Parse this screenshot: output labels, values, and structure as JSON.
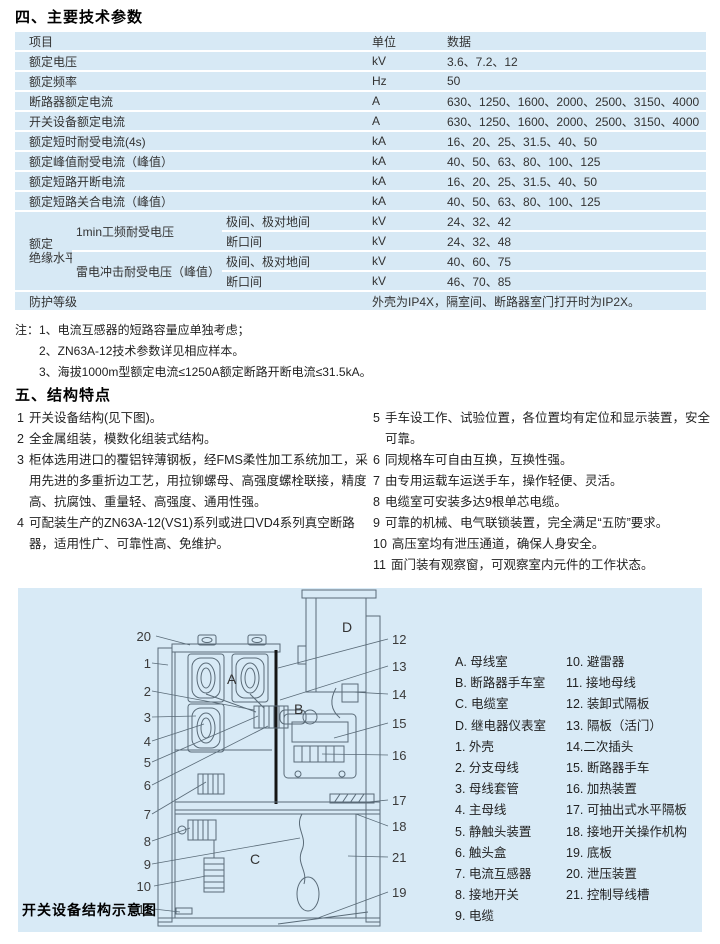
{
  "colors": {
    "table_bg": "#d7e9f5",
    "panel_bg": "#d8eaf6"
  },
  "s4": {
    "title": "四、主要技术参数",
    "table": {
      "col_item": "项目",
      "col_unit": "单位",
      "col_data": "数据",
      "rows": [
        {
          "item": "额定电压",
          "unit": "kV",
          "data": "3.6、7.2、12"
        },
        {
          "item": "额定频率",
          "unit": "Hz",
          "data": "50"
        },
        {
          "item": "断路器额定电流",
          "unit": "A",
          "data": "630、1250、1600、2000、2500、3150、4000"
        },
        {
          "item": "开关设备额定电流",
          "unit": "A",
          "data": "630、1250、1600、2000、2500、3150、4000"
        },
        {
          "item": "额定短时耐受电流(4s)",
          "unit": "kA",
          "data": "16、20、25、31.5、40、50"
        },
        {
          "item": "额定峰值耐受电流（峰值）",
          "unit": "kA",
          "data": "40、50、63、80、100、125"
        },
        {
          "item": "额定短路开断电流",
          "unit": "kA",
          "data": "16、20、25、31.5、40、50"
        },
        {
          "item": "额定短路关合电流（峰值）",
          "unit": "kA",
          "data": "40、50、63、80、100、125"
        }
      ],
      "insulation": {
        "group_line1": "额定",
        "group_line2": "绝缘水平",
        "power_freq_label": "1min工频耐受电压",
        "impulse_label": "雷电冲击耐受电压（峰值）",
        "between_poles": "极间、极对地间",
        "across_gap": "断口间",
        "unit": "kV",
        "pf_poles_data": "24、32、42",
        "pf_gap_data": "24、32、48",
        "imp_poles_data": "40、60、75",
        "imp_gap_data": "46、70、85"
      },
      "protection": {
        "item": "防护等级",
        "data": "外壳为IP4X，隔室间、断路器室门打开时为IP2X。"
      }
    },
    "notes_prefix": "注：",
    "notes": [
      "1、电流互感器的短路容量应单独考虑；",
      "2、ZN63A-12技术参数详见相应样本。",
      "3、海拔1000m型额定电流≤1250A额定断路开断电流≤31.5kA。"
    ]
  },
  "s5": {
    "title": "五、结构特点",
    "left": [
      {
        "num": "1",
        "text": "开关设备结构(见下图)。"
      },
      {
        "num": "2",
        "text": "全金属组装，模数化组装式结构。"
      },
      {
        "num": "3",
        "text": "柜体选用进口的覆铝锌薄钢板，经FMS柔性加工系统加工，采用先进的多重折边工艺，用拉铆螺母、高强度螺栓联接，精度高、抗腐蚀、重量轻、高强度、通用性强。"
      },
      {
        "num": "4",
        "text": "可配装生产的ZN63A-12(VS1)系列或进口VD4系列真空断路器，适用性广、可靠性高、免维护。"
      }
    ],
    "right": [
      {
        "num": "5",
        "text": "手车设工作、试验位置，各位置均有定位和显示装置，安全可靠。"
      },
      {
        "num": "6",
        "text": "同规格车可自由互换，互换性强。"
      },
      {
        "num": "7",
        "text": "由专用运载车运送手车，操作轻便、灵活。"
      },
      {
        "num": "8",
        "text": "电缆室可安装多达9根单芯电缆。"
      },
      {
        "num": "9",
        "text": "可靠的机械、电气联锁装置，完全满足“五防”要求。"
      },
      {
        "num": "10",
        "text": "高压室均有泄压通道，确保人身安全。"
      },
      {
        "num": "11",
        "text": "面门装有观察窗，可观察室内元件的工作状态。"
      }
    ]
  },
  "diagram": {
    "caption": "开关设备结构示意图",
    "compartments": {
      "a": "A",
      "b": "B",
      "c": "C",
      "d": "D"
    },
    "left_labels": [
      "20",
      "1",
      "2",
      "3",
      "4",
      "5",
      "6",
      "7",
      "8",
      "9",
      "10",
      "11"
    ],
    "right_labels": [
      "12",
      "13",
      "14",
      "15",
      "16",
      "17",
      "18",
      "21",
      "19"
    ],
    "legend_col1": [
      "A. 母线室",
      "B. 断路器手车室",
      "C. 电缆室",
      "D. 继电器仪表室",
      "1. 外壳",
      "2. 分支母线",
      "3. 母线套管",
      "4. 主母线",
      "5. 静触头装置",
      "6. 触头盒",
      "7. 电流互感器",
      "8. 接地开关",
      "9. 电缆"
    ],
    "legend_col2": [
      "10. 避雷器",
      "11. 接地母线",
      "12. 装卸式隔板",
      "13. 隔板（活门）",
      "14.二次插头",
      "15. 断路器手车",
      "16. 加热装置",
      "17. 可抽出式水平隔板",
      "18. 接地开关操作机构",
      "19. 底板",
      "20. 泄压装置",
      "21. 控制导线槽"
    ]
  }
}
